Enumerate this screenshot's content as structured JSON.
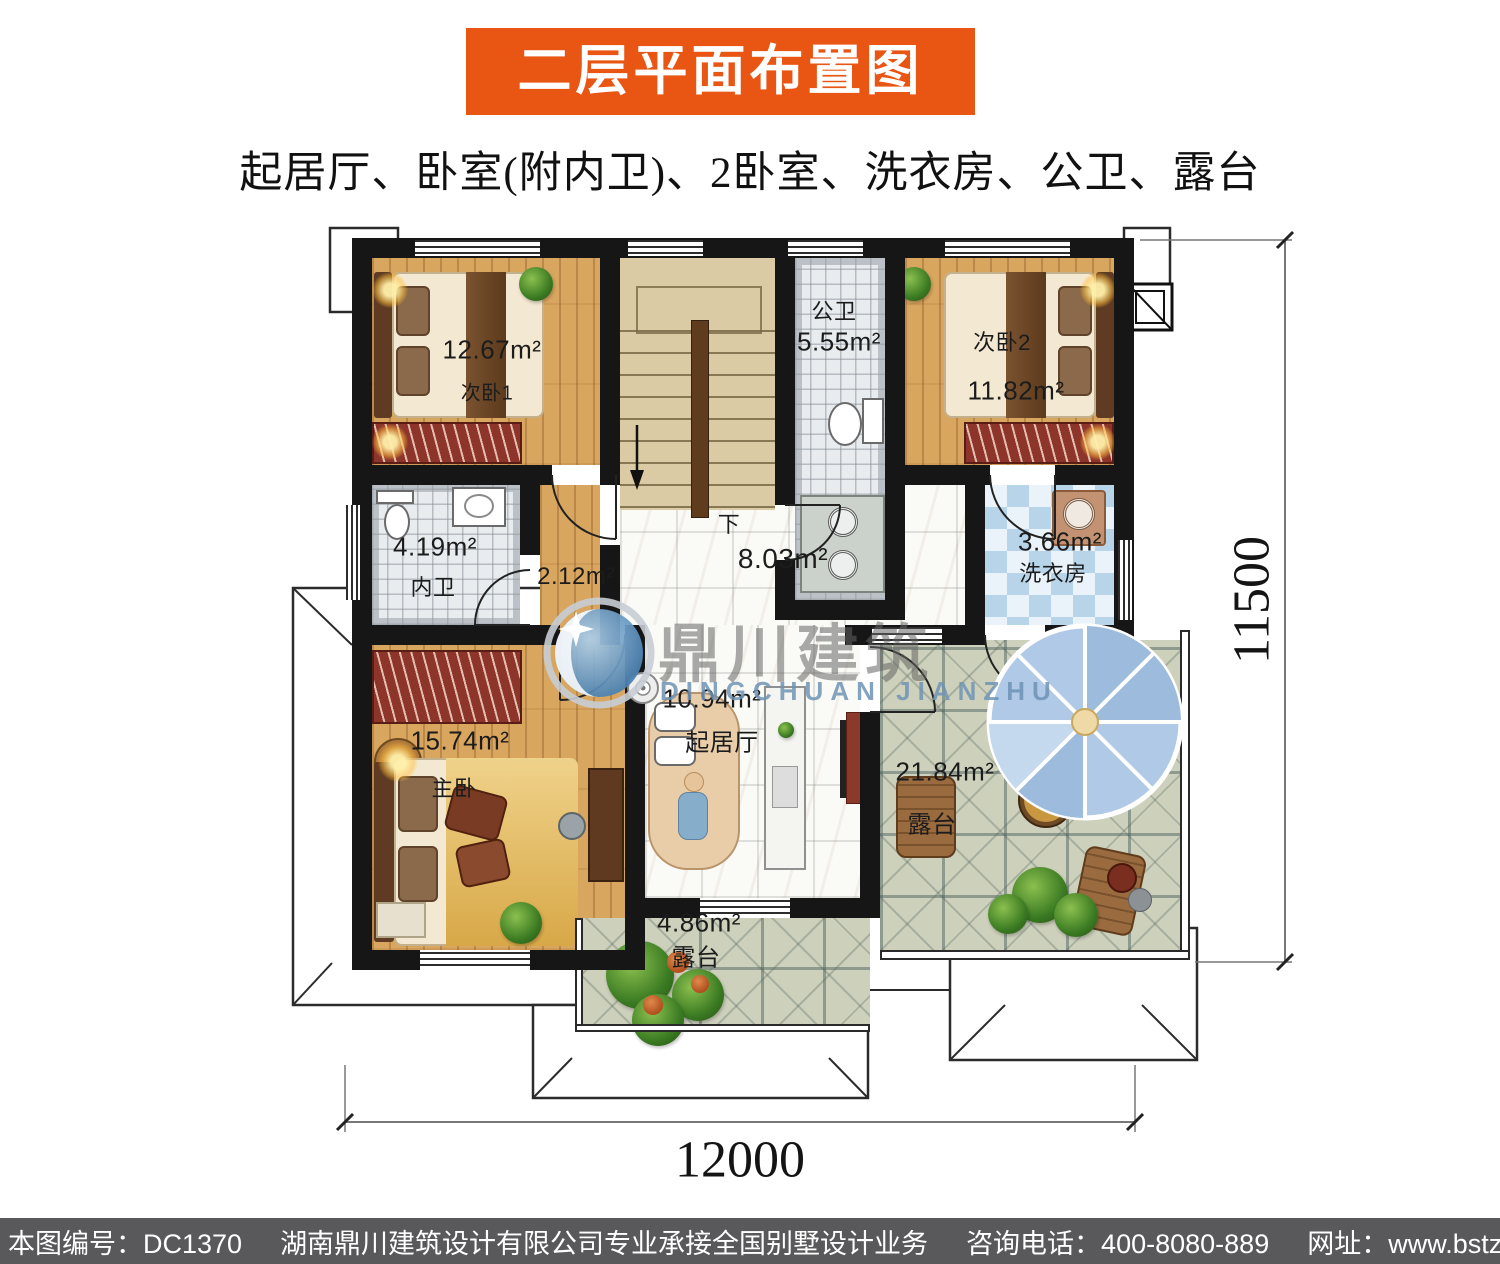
{
  "header": {
    "title": "二层平面布置图",
    "subtitle": "起居厅、卧室(附内卫)、2卧室、洗衣房、公卫、露台"
  },
  "rooms": {
    "bedroom1": {
      "area": "12.67m²",
      "name": "次卧1"
    },
    "public_bath": {
      "name": "公卫",
      "area": "5.55m²"
    },
    "bedroom2": {
      "name": "次卧2",
      "area": "11.82m²"
    },
    "inner_bath": {
      "area": "4.19m²",
      "name": "内卫"
    },
    "corridor": {
      "area": "2.12m²"
    },
    "stair_hall": {
      "down_label": "下",
      "area": "8.03m²"
    },
    "laundry": {
      "area": "3.66m²",
      "name": "洗衣房"
    },
    "master_bedroom": {
      "area": "15.74m²",
      "name": "主卧"
    },
    "living": {
      "area": "10.94m²",
      "name": "起居厅"
    },
    "terrace_main": {
      "area": "21.84m²",
      "name": "露台"
    },
    "terrace_front": {
      "area": "4.86m²",
      "name": "露台"
    }
  },
  "dimensions": {
    "bottom": "12000",
    "right": "11500"
  },
  "watermark": {
    "cn": "鼎川建筑",
    "en": "DINGCHUAN JIANZHU"
  },
  "footer": {
    "sheet_no": "本图编号：DC1370",
    "company": "湖南鼎川建筑设计有限公司专业承接全国别墅设计业务",
    "phone": "咨询电话：400-8080-889",
    "website": "网址：www.bstzcs.com"
  },
  "colors": {
    "banner_bg": "#E95513",
    "footer_bg": "#59595B",
    "wall": "#161616",
    "wood": "#D8A65F",
    "marble": "#FAFAF7",
    "tile": "#E8ECEF",
    "checker": "#B7D4E9",
    "stair": "#DACBA5",
    "terrace": "#CDD0BB",
    "umbrella": "#AFC9E6",
    "watermark_blue": "#6F93B5"
  }
}
